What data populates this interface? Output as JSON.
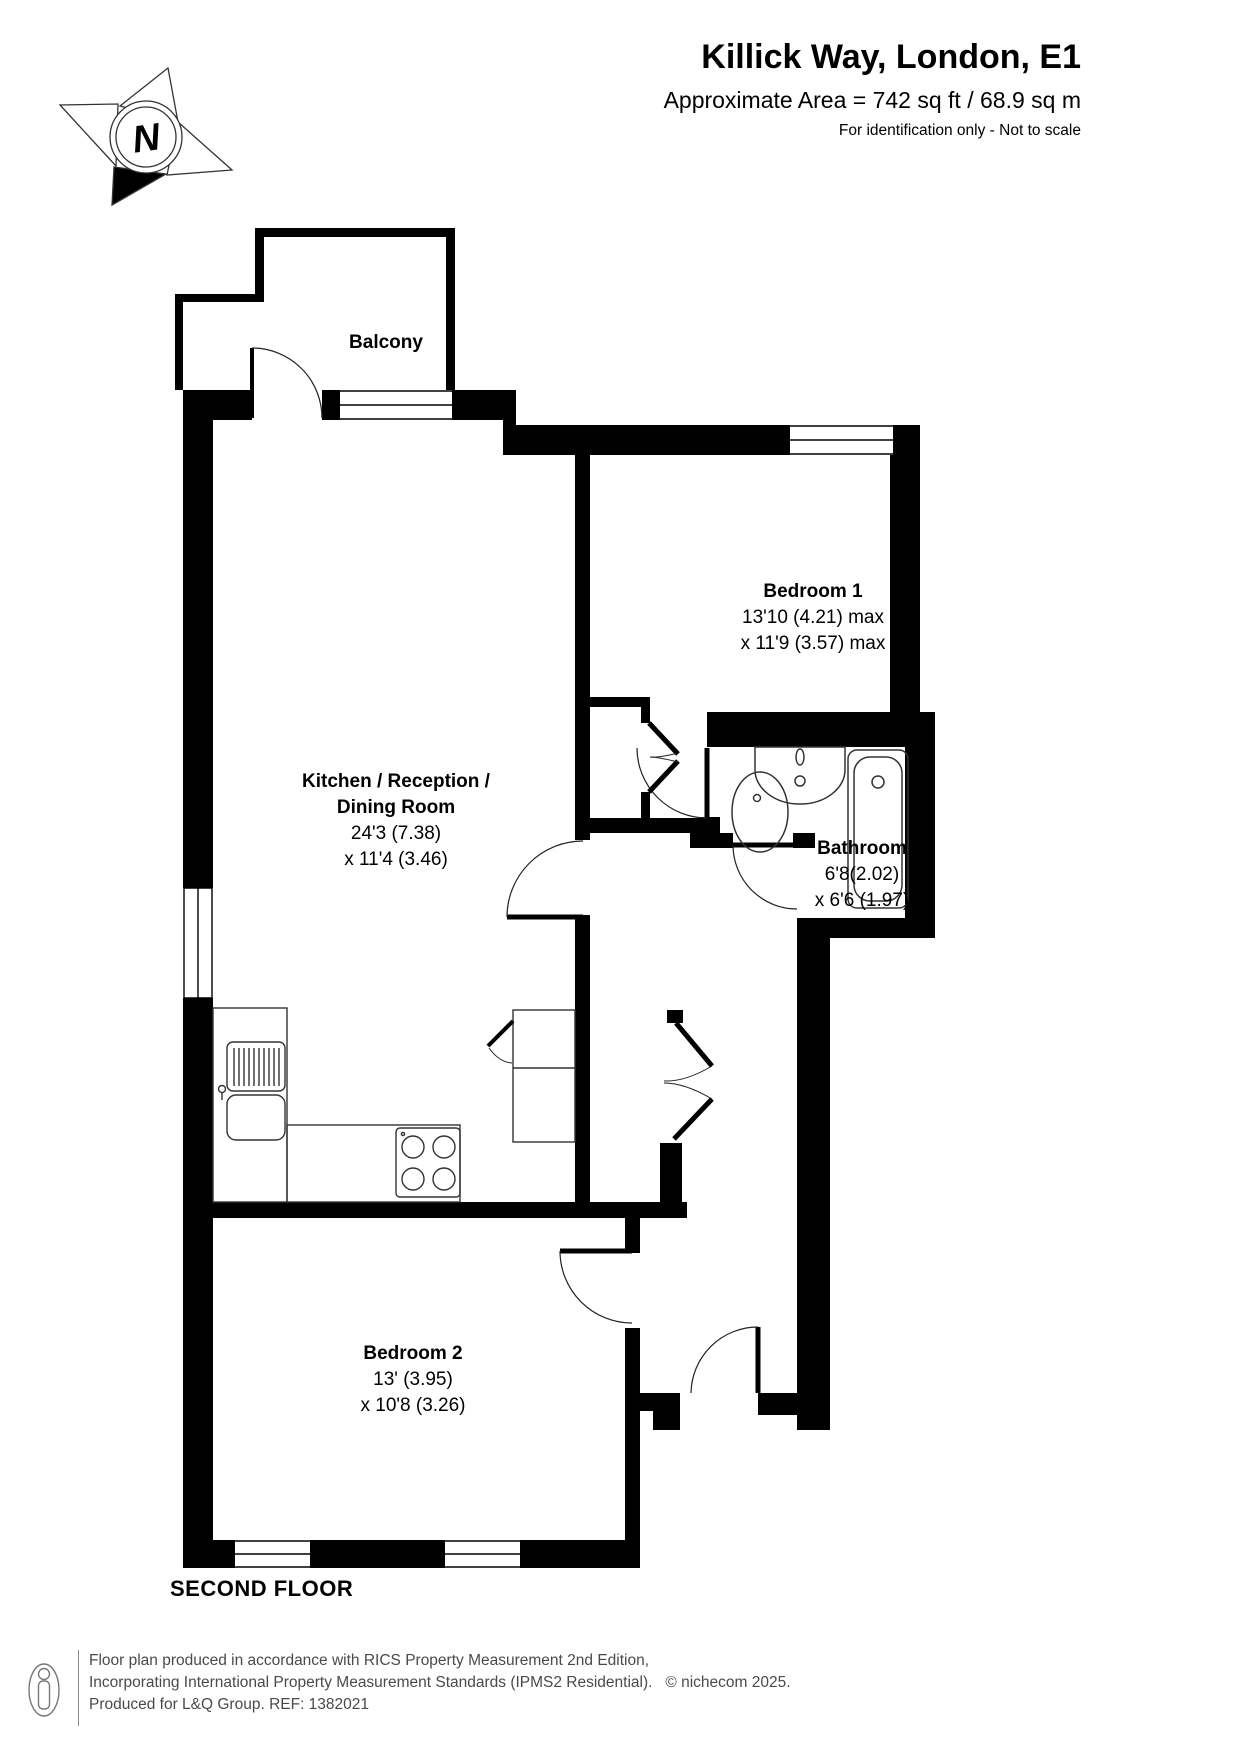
{
  "header": {
    "title": "Killick Way, London, E1",
    "area": "Approximate Area = 742 sq ft / 68.9 sq m",
    "note": "For identification only - Not to scale"
  },
  "compass": {
    "north": "N"
  },
  "plan": {
    "balcony": {
      "name": "Balcony"
    },
    "bedroom1": {
      "name": "Bedroom 1",
      "dim1": "13'10 (4.21) max",
      "dim2": "x 11'9 (3.57) max"
    },
    "kitchen": {
      "name1": "Kitchen / Reception /",
      "name2": "Dining Room",
      "dim1": "24'3 (7.38)",
      "dim2": "x 11'4 (3.46)"
    },
    "bathroom": {
      "name": "Bathroom",
      "dim1": "6'8(2.02)",
      "dim2": "x 6'6 (1.97)"
    },
    "bedroom2": {
      "name": "Bedroom 2",
      "dim1": "13' (3.95)",
      "dim2": "x 10'8 (3.26)"
    }
  },
  "floor_label": "SECOND FLOOR",
  "footer": {
    "line1": "Floor plan produced in accordance with RICS Property Measurement 2nd Edition,",
    "line2": "Incorporating International Property Measurement Standards (IPMS2 Residential).",
    "copyright": "© nichecom 2025.",
    "line3": "Produced for L&Q Group.   REF: 1382021"
  }
}
